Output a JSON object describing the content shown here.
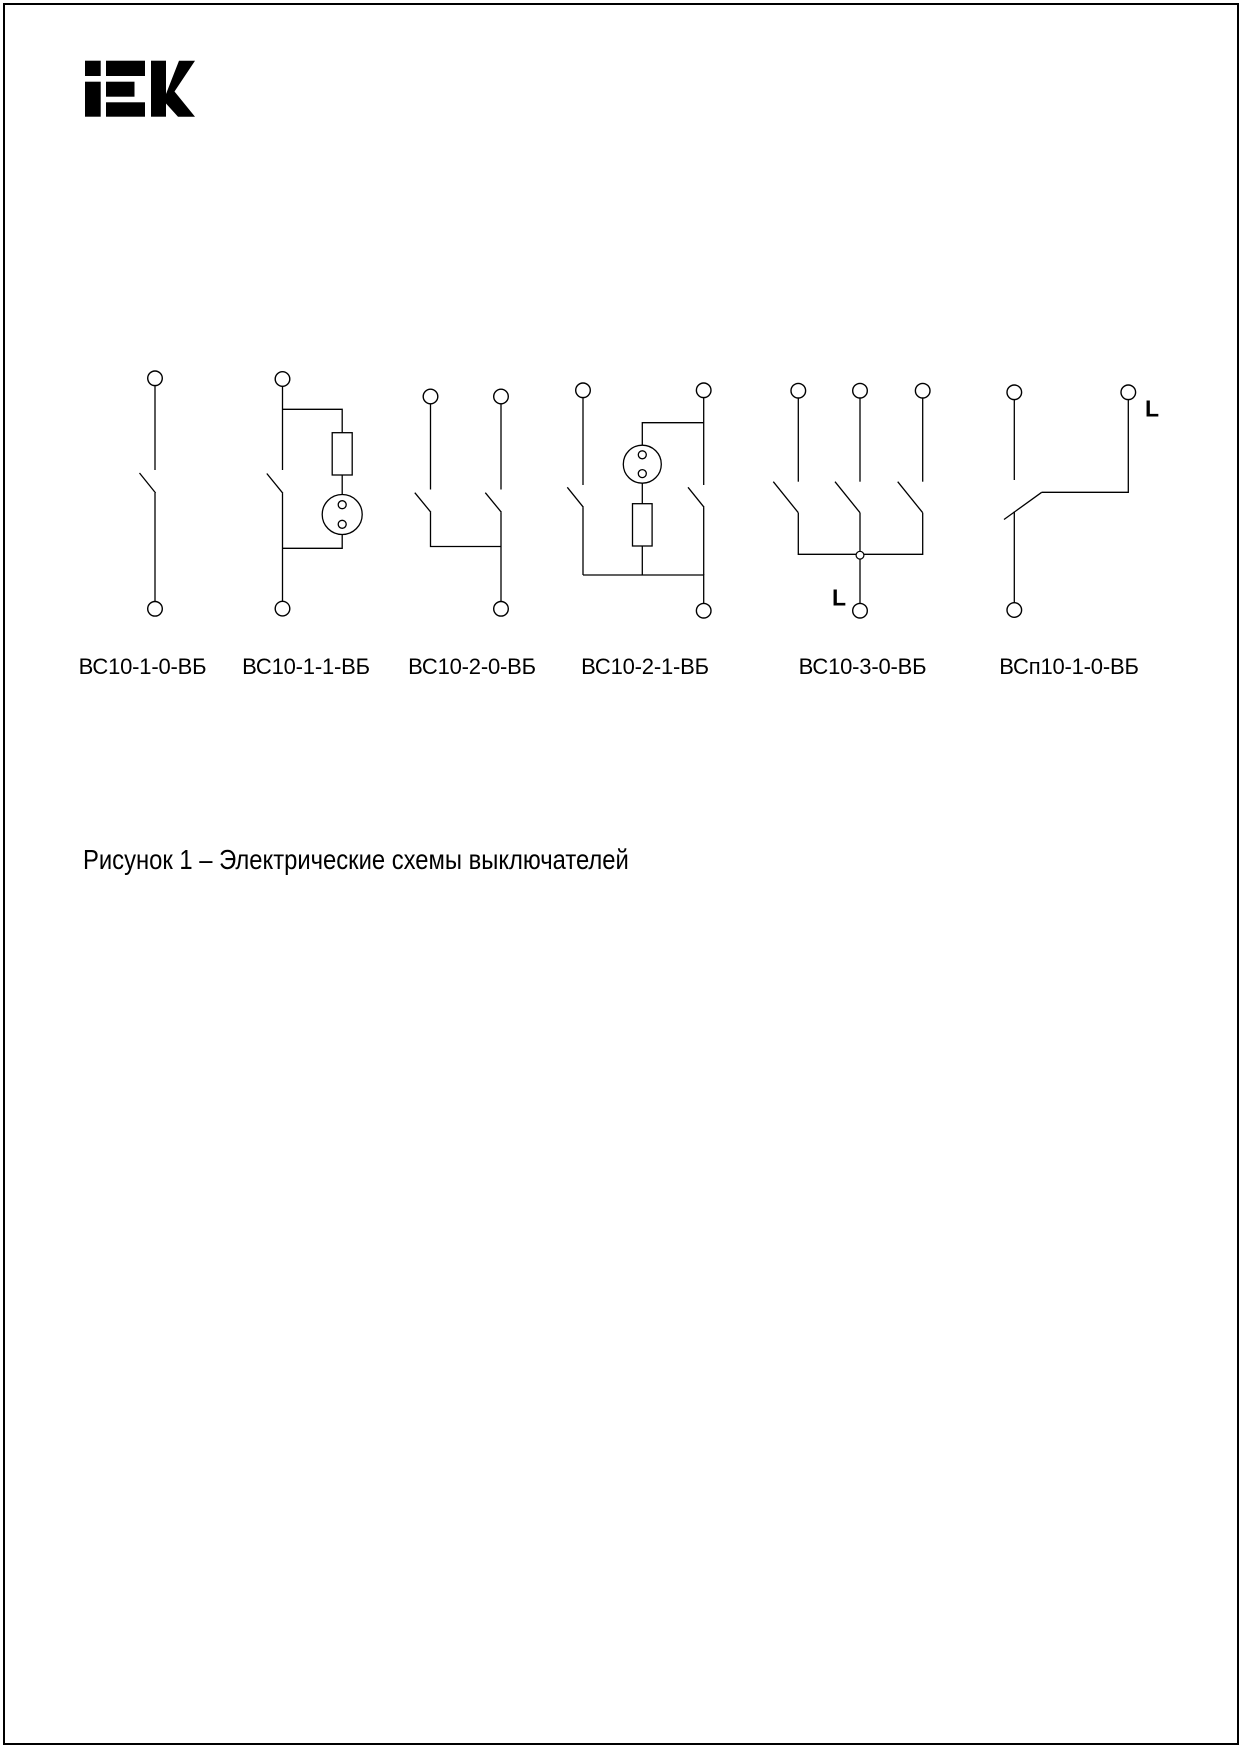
{
  "logo": {
    "text": "iEK"
  },
  "figure": {
    "caption": "Рисунок 1 – Электрические схемы выключателей"
  },
  "diagrams": [
    {
      "label": "ВС10-1-0-ВБ"
    },
    {
      "label": "ВС10-1-1-ВБ"
    },
    {
      "label": "ВС10-2-0-ВБ"
    },
    {
      "label": "ВС10-2-1-ВБ"
    },
    {
      "label": "ВС10-3-0-ВБ",
      "line_label": "L"
    },
    {
      "label": "ВСп10-1-0-ВБ",
      "line_label": "L"
    }
  ]
}
